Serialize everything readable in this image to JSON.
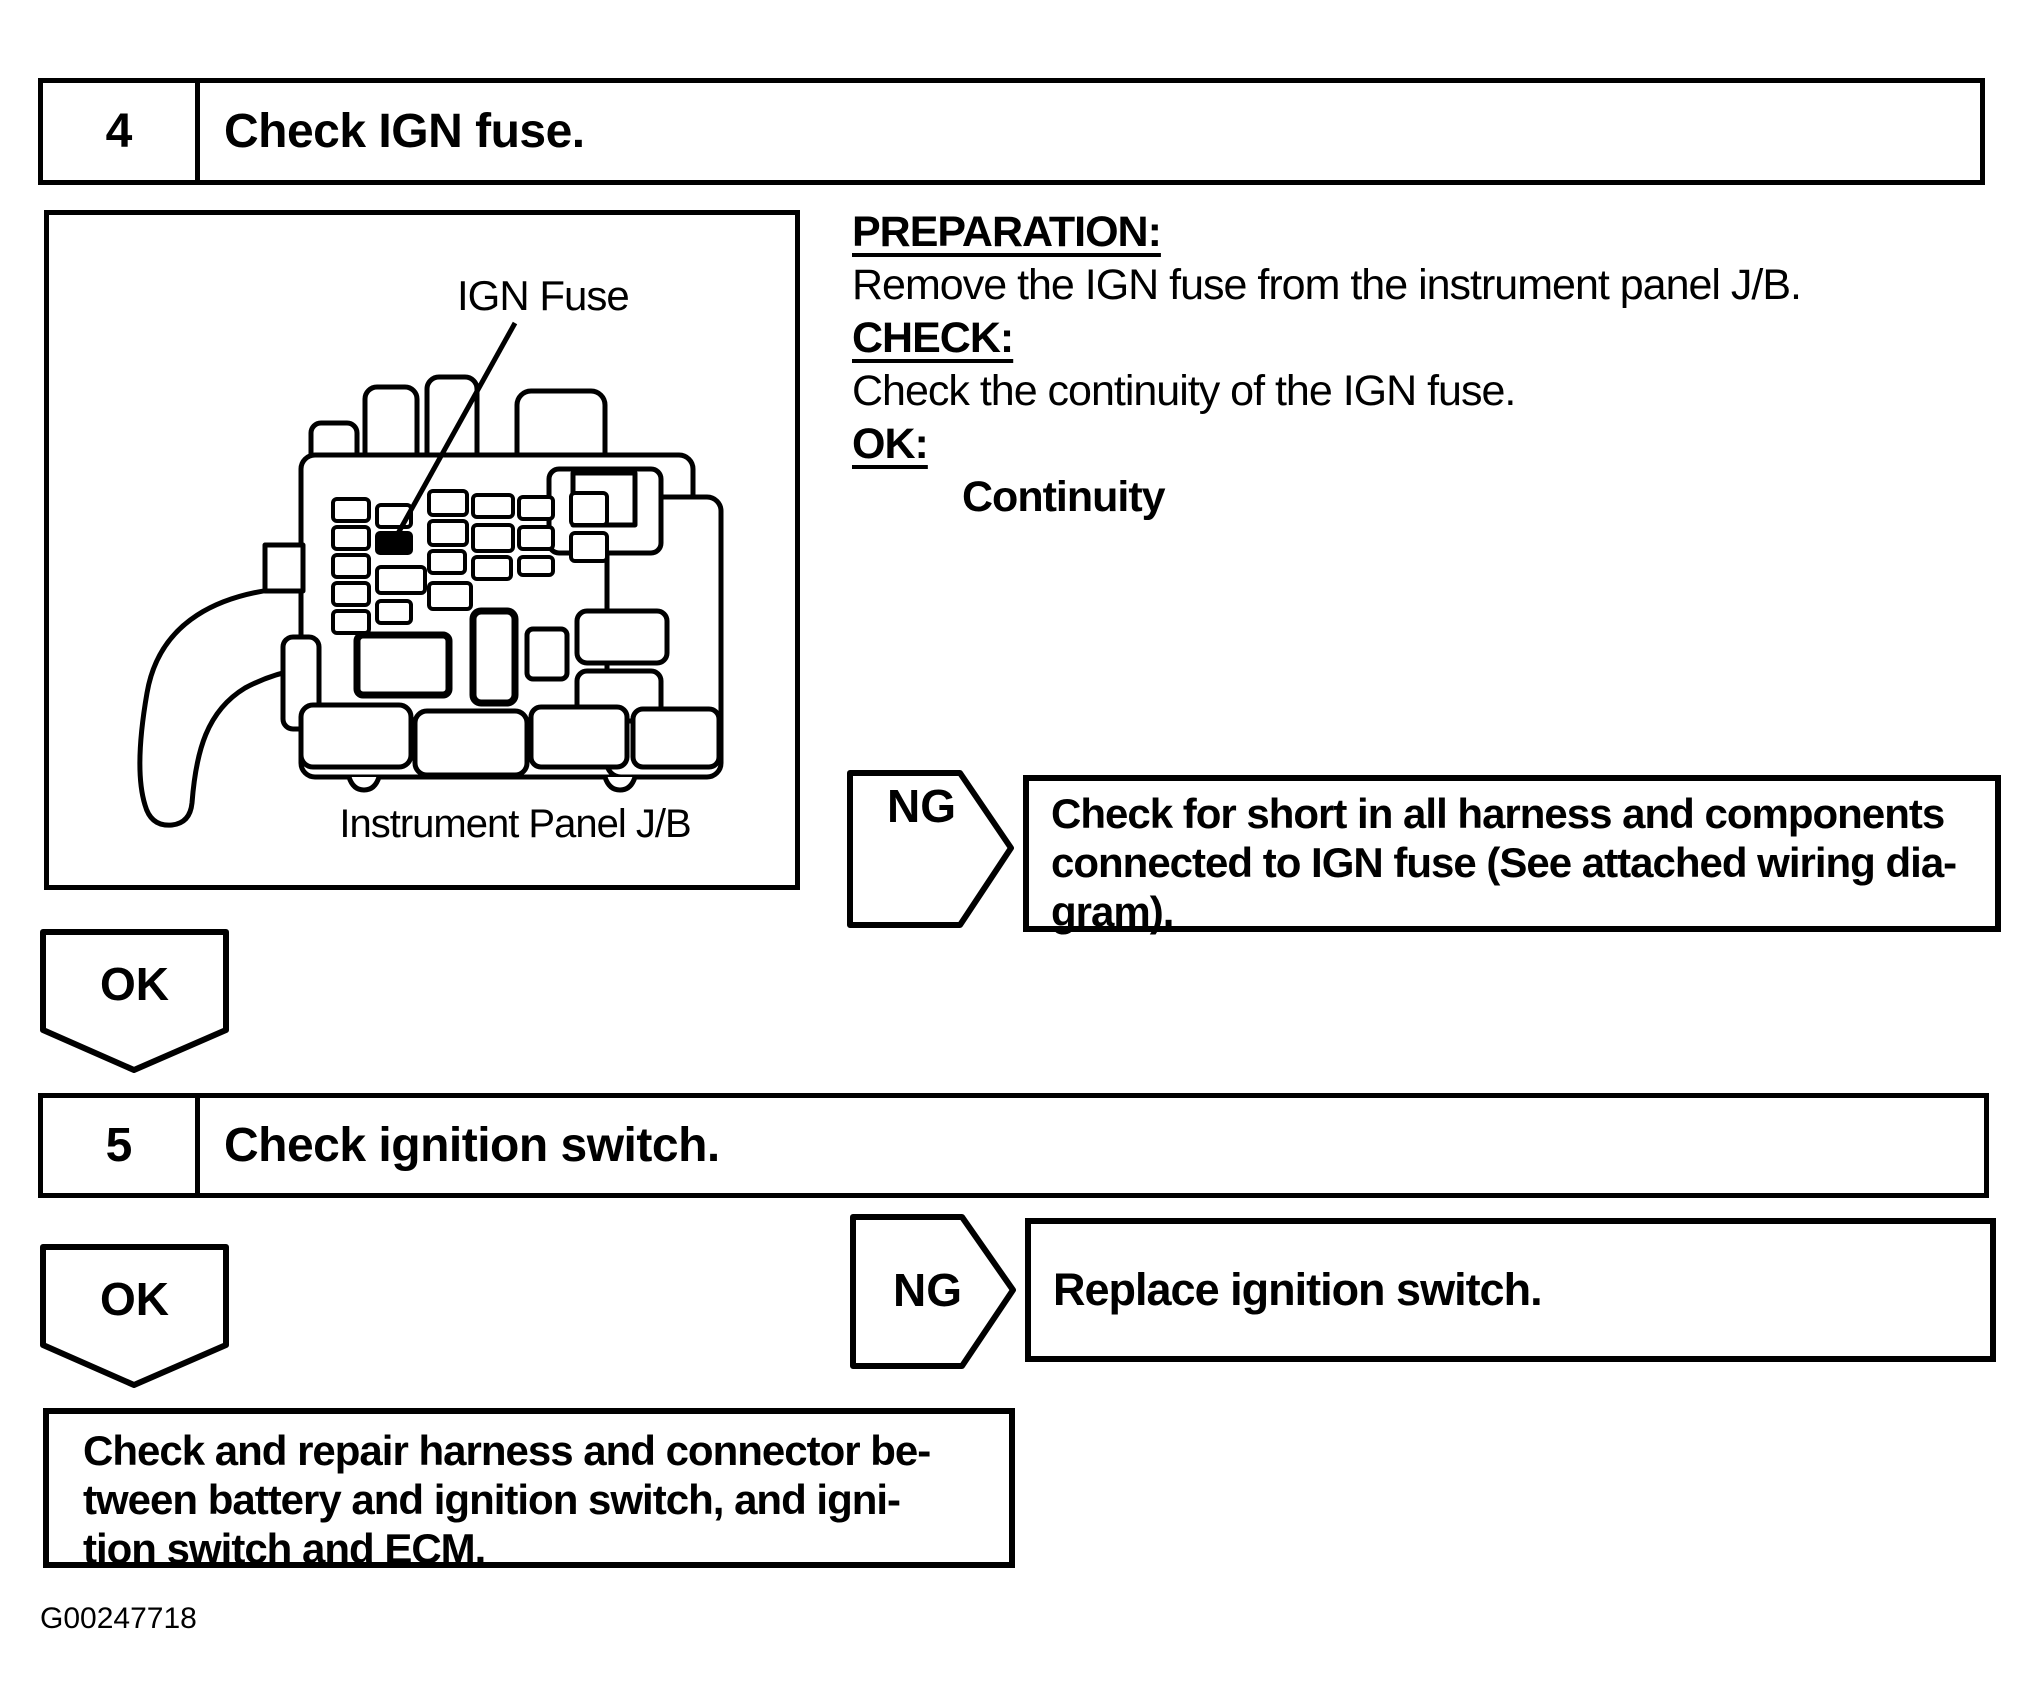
{
  "colors": {
    "ink": "#000000",
    "paper": "#ffffff"
  },
  "figure_id": "G00247718",
  "step4": {
    "number": "4",
    "title": "Check IGN fuse.",
    "illustration": {
      "label": "IGN Fuse",
      "caption": "Instrument Panel J/B"
    },
    "instructions": [
      {
        "heading": "PREPARATION:",
        "text": "Remove the IGN fuse from the instrument panel J/B."
      },
      {
        "heading": "CHECK:",
        "text": "Check the continuity of the IGN fuse."
      },
      {
        "heading": "OK:",
        "text": "Continuity"
      }
    ],
    "ng_label": "NG",
    "ng_lines": [
      "Check for short in all harness and components",
      "connected to IGN fuse (See attached wiring dia-",
      "gram)."
    ],
    "ok_label": "OK"
  },
  "step5": {
    "number": "5",
    "title": "Check ignition switch.",
    "ng_label": "NG",
    "ng_text": "Replace ignition switch.",
    "ok_label": "OK",
    "result_lines": [
      "Check and repair harness and connector be-",
      "tween battery and ignition switch, and igni-",
      "tion switch and ECM."
    ]
  }
}
